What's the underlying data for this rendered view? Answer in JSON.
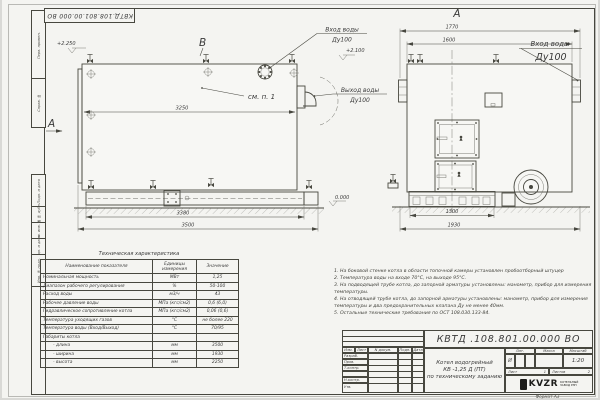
{
  "frame": {
    "doc_number_top": "КВТД.108.801.00.000 ВО",
    "stamp_fields": [
      "Перв. примен.",
      "Справ. №",
      "Подп. и дата",
      "Инв. № дубл.",
      "Взам. инв. №",
      "Подп. и дата",
      "Инв. № подл."
    ],
    "format_note": "Формат А3"
  },
  "side_view": {
    "section_label": "В",
    "view_arrow_label": "А",
    "elevation_top": "+2.250",
    "inlet_line1": "Вход воды",
    "inlet_line2": "Ду100",
    "inlet_elevation": "+2.100",
    "outlet_line1": "Выход воды",
    "outlet_line2": "Ду100",
    "see_item": "см. п. 1",
    "dim_body": "3250",
    "dim_frame": "3380",
    "dim_overall": "3500",
    "elevation_zero": "0.000"
  },
  "front_view": {
    "title": "А",
    "dim_flanges": "1770",
    "dim_body": "1600",
    "inlet_line1": "Вход воды",
    "inlet_line2": "Ду100",
    "dim_base": "1300",
    "dim_overall": "1930"
  },
  "notes": [
    "1.  На боковой стенке котла в области топочной камеры установлен пробоотборный штуцер",
    "2.  Температура воды на входе 70°С, на выходе 95°С.",
    "3.  На подводящей трубе котла, до запорной арматуры установлены: манометр, прибор для измерения температуры.",
    "4.  На отводящей трубе котла, до запорной арматуры установлены: манометр, прибор для измерения температуры и два предохранительных клапана Ду не менее 40мм.",
    "5.  Остальные технические требования по ОСТ 108.030.133-84."
  ],
  "tech_table": {
    "title": "Техническая характеристика",
    "headers": [
      "Наименование показателя",
      "Единицы измерения",
      "Значение"
    ],
    "rows": [
      [
        "Номинальная мощность",
        "МВт",
        "1,25"
      ],
      [
        "Диапазон рабочего регулирования",
        "%",
        "50-100"
      ],
      [
        "Расход воды",
        "м3/ч",
        "43"
      ],
      [
        "Рабочее давление воды",
        "МПа (кгс/см2)",
        "0,6 (6,0)"
      ],
      [
        "Гидравлическое сопротивление котла",
        "МПа (кгс/см2)",
        "0,06 (0,6)"
      ],
      [
        "Температура уходящих газов",
        "°С",
        "не более 220"
      ],
      [
        "Температура воды (Вход/Выход)",
        "°С",
        "70/95"
      ],
      [
        "Габариты котла",
        "",
        ""
      ],
      [
        "- длина",
        "мм",
        "3500"
      ],
      [
        "- ширина",
        "мм",
        "1930"
      ],
      [
        "- высота",
        "мм",
        "2250"
      ]
    ]
  },
  "title_block": {
    "doc_number": "КВТД .108.801.00.000  ВО",
    "rev_headers": [
      "Изм.",
      "Лист",
      "N докум.",
      "Подп.",
      "Дата"
    ],
    "sign_rows": [
      "Разраб.",
      "Пров.",
      "Т.контр.",
      "Н.контр.",
      "Утв."
    ],
    "product_line1": "Котел водогрейный",
    "product_line2": "КВ -1,25 Д (ПТ)",
    "product_line3": "по техническому заданию",
    "lit_header": "Лит.",
    "mass_header": "Масса",
    "scale_header": "Масштаб",
    "lit_value": "И",
    "scale_value": "1:20",
    "sheet_label": "Лист",
    "sheet_value": "1",
    "sheets_label": "Листов",
    "sheets_value": "2",
    "logo_text": "KVZR",
    "logo_sub1": "КОТЕЛЬНЫЙ",
    "logo_sub2": "ЗАВОД РЭП"
  }
}
